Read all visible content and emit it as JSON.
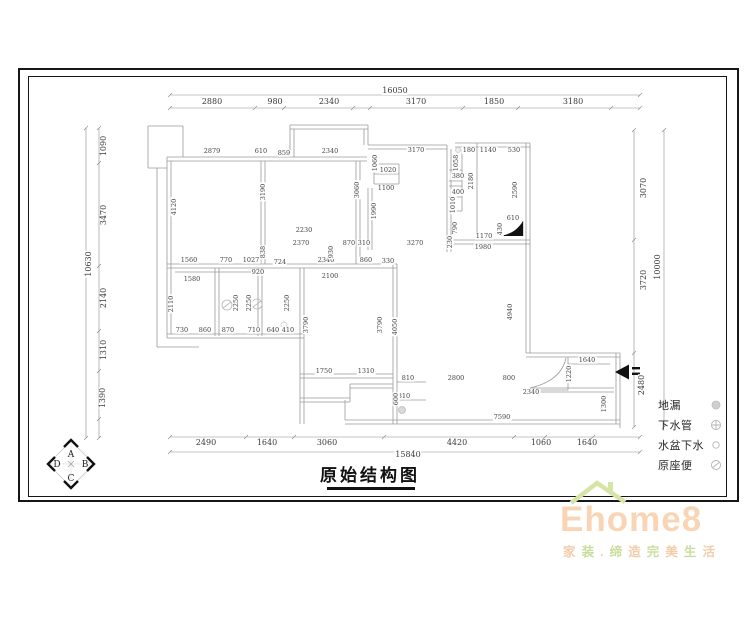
{
  "title": {
    "text": "原始结构图"
  },
  "legend": {
    "items": [
      {
        "label": "地漏"
      },
      {
        "label": "下水管"
      },
      {
        "label": "水盆下水"
      },
      {
        "label": "原座便"
      }
    ]
  },
  "compass": {
    "top": "A",
    "right": "B",
    "bottom": "C",
    "left": "D"
  },
  "logo": {
    "brand": "Ehome8",
    "tagline": "家装.缔造完美生活"
  },
  "colors": {
    "brand_text": "#f9d5b6",
    "brand_roof": "#d6e4a6",
    "tagline_a": "#f2cdab",
    "tagline_b": "#c9dd9d",
    "wall_line": "#9b9b9b",
    "dim_line": "#8a8a8a"
  },
  "dims": {
    "boundary": [
      {
        "t": "16050",
        "x": 395,
        "y": 91
      },
      {
        "t": "2880",
        "x": 212,
        "y": 102
      },
      {
        "t": "980",
        "x": 275,
        "y": 102
      },
      {
        "t": "2340",
        "x": 329,
        "y": 102
      },
      {
        "t": "3170",
        "x": 416,
        "y": 102
      },
      {
        "t": "1850",
        "x": 494,
        "y": 102
      },
      {
        "t": "3180",
        "x": 573,
        "y": 102
      },
      {
        "t": "1090",
        "x": 104,
        "y": 146,
        "r": 1
      },
      {
        "t": "3470",
        "x": 104,
        "y": 215,
        "r": 1
      },
      {
        "t": "10630",
        "x": 89,
        "y": 264,
        "r": 1
      },
      {
        "t": "2140",
        "x": 104,
        "y": 298,
        "r": 1
      },
      {
        "t": "1310",
        "x": 104,
        "y": 350,
        "r": 1
      },
      {
        "t": "1390",
        "x": 103,
        "y": 398,
        "r": 1
      },
      {
        "t": "3070",
        "x": 644,
        "y": 188,
        "r": 1
      },
      {
        "t": "3720",
        "x": 644,
        "y": 280,
        "r": 1
      },
      {
        "t": "10000",
        "x": 658,
        "y": 267,
        "r": 1
      },
      {
        "t": "2480",
        "x": 642,
        "y": 385,
        "r": 1
      },
      {
        "t": "2490",
        "x": 206,
        "y": 443
      },
      {
        "t": "1640",
        "x": 267,
        "y": 443
      },
      {
        "t": "3060",
        "x": 327,
        "y": 443
      },
      {
        "t": "4420",
        "x": 457,
        "y": 443
      },
      {
        "t": "1060",
        "x": 541,
        "y": 443
      },
      {
        "t": "1640",
        "x": 587,
        "y": 443
      },
      {
        "t": "15840",
        "x": 408,
        "y": 455
      }
    ],
    "interior": [
      {
        "t": "2879",
        "x": 212,
        "y": 151
      },
      {
        "t": "610",
        "x": 261,
        "y": 151
      },
      {
        "t": "859",
        "x": 284,
        "y": 153
      },
      {
        "t": "2340",
        "x": 330,
        "y": 151
      },
      {
        "t": "3170",
        "x": 416,
        "y": 150
      },
      {
        "t": "180",
        "x": 469,
        "y": 150
      },
      {
        "t": "1140",
        "x": 488,
        "y": 150
      },
      {
        "t": "530",
        "x": 514,
        "y": 150
      },
      {
        "t": "1060",
        "x": 375,
        "y": 163,
        "r": 1
      },
      {
        "t": "1020",
        "x": 388,
        "y": 170
      },
      {
        "t": "1100",
        "x": 386,
        "y": 188
      },
      {
        "t": "1990",
        "x": 374,
        "y": 211,
        "r": 1
      },
      {
        "t": "3060",
        "x": 357,
        "y": 190,
        "r": 1
      },
      {
        "t": "3190",
        "x": 263,
        "y": 192,
        "r": 1
      },
      {
        "t": "4120",
        "x": 174,
        "y": 207,
        "r": 1
      },
      {
        "t": "1058",
        "x": 456,
        "y": 163,
        "r": 1
      },
      {
        "t": "380",
        "x": 458,
        "y": 176
      },
      {
        "t": "2180",
        "x": 471,
        "y": 181,
        "r": 1
      },
      {
        "t": "400",
        "x": 458,
        "y": 192
      },
      {
        "t": "1010",
        "x": 453,
        "y": 205,
        "r": 1
      },
      {
        "t": "2590",
        "x": 515,
        "y": 190,
        "r": 1
      },
      {
        "t": "790",
        "x": 455,
        "y": 228,
        "r": 1
      },
      {
        "t": "610",
        "x": 513,
        "y": 218
      },
      {
        "t": "430",
        "x": 500,
        "y": 229,
        "r": 1
      },
      {
        "t": "1170",
        "x": 484,
        "y": 236
      },
      {
        "t": "230",
        "x": 450,
        "y": 242,
        "r": 1
      },
      {
        "t": "1980",
        "x": 483,
        "y": 247
      },
      {
        "t": "3270",
        "x": 415,
        "y": 243
      },
      {
        "t": "2230",
        "x": 304,
        "y": 230
      },
      {
        "t": "2370",
        "x": 301,
        "y": 243
      },
      {
        "t": "870",
        "x": 349,
        "y": 243
      },
      {
        "t": "310",
        "x": 364,
        "y": 243
      },
      {
        "t": "1560",
        "x": 189,
        "y": 260
      },
      {
        "t": "770",
        "x": 226,
        "y": 260
      },
      {
        "t": "1027",
        "x": 251,
        "y": 260
      },
      {
        "t": "724",
        "x": 280,
        "y": 262
      },
      {
        "t": "920",
        "x": 258,
        "y": 272
      },
      {
        "t": "1580",
        "x": 192,
        "y": 279
      },
      {
        "t": "2340",
        "x": 326,
        "y": 260
      },
      {
        "t": "860",
        "x": 366,
        "y": 260
      },
      {
        "t": "330",
        "x": 388,
        "y": 261
      },
      {
        "t": "2100",
        "x": 330,
        "y": 276
      },
      {
        "t": "838",
        "x": 263,
        "y": 252,
        "r": 1
      },
      {
        "t": "930",
        "x": 331,
        "y": 252,
        "r": 1
      },
      {
        "t": "2110",
        "x": 171,
        "y": 304,
        "r": 1
      },
      {
        "t": "2250",
        "x": 236,
        "y": 303,
        "r": 1
      },
      {
        "t": "2250",
        "x": 249,
        "y": 303,
        "r": 1
      },
      {
        "t": "2250",
        "x": 287,
        "y": 303,
        "r": 1
      },
      {
        "t": "730",
        "x": 182,
        "y": 330
      },
      {
        "t": "860",
        "x": 205,
        "y": 330
      },
      {
        "t": "870",
        "x": 228,
        "y": 330
      },
      {
        "t": "710",
        "x": 254,
        "y": 330
      },
      {
        "t": "640",
        "x": 273,
        "y": 330
      },
      {
        "t": "410",
        "x": 288,
        "y": 330
      },
      {
        "t": "3790",
        "x": 306,
        "y": 325,
        "r": 1
      },
      {
        "t": "3790",
        "x": 380,
        "y": 325,
        "r": 1
      },
      {
        "t": "4050",
        "x": 395,
        "y": 327,
        "r": 1
      },
      {
        "t": "4940",
        "x": 510,
        "y": 312,
        "r": 1
      },
      {
        "t": "1750",
        "x": 324,
        "y": 371
      },
      {
        "t": "1310",
        "x": 366,
        "y": 371
      },
      {
        "t": "810",
        "x": 408,
        "y": 378
      },
      {
        "t": "2800",
        "x": 456,
        "y": 378
      },
      {
        "t": "800",
        "x": 509,
        "y": 378
      },
      {
        "t": "810",
        "x": 404,
        "y": 396
      },
      {
        "t": "600",
        "x": 396,
        "y": 399,
        "r": 1
      },
      {
        "t": "1640",
        "x": 587,
        "y": 360
      },
      {
        "t": "1220",
        "x": 569,
        "y": 374,
        "r": 1
      },
      {
        "t": "2340",
        "x": 531,
        "y": 392
      },
      {
        "t": "1300",
        "x": 604,
        "y": 404,
        "r": 1
      },
      {
        "t": "7590",
        "x": 502,
        "y": 417
      }
    ]
  }
}
